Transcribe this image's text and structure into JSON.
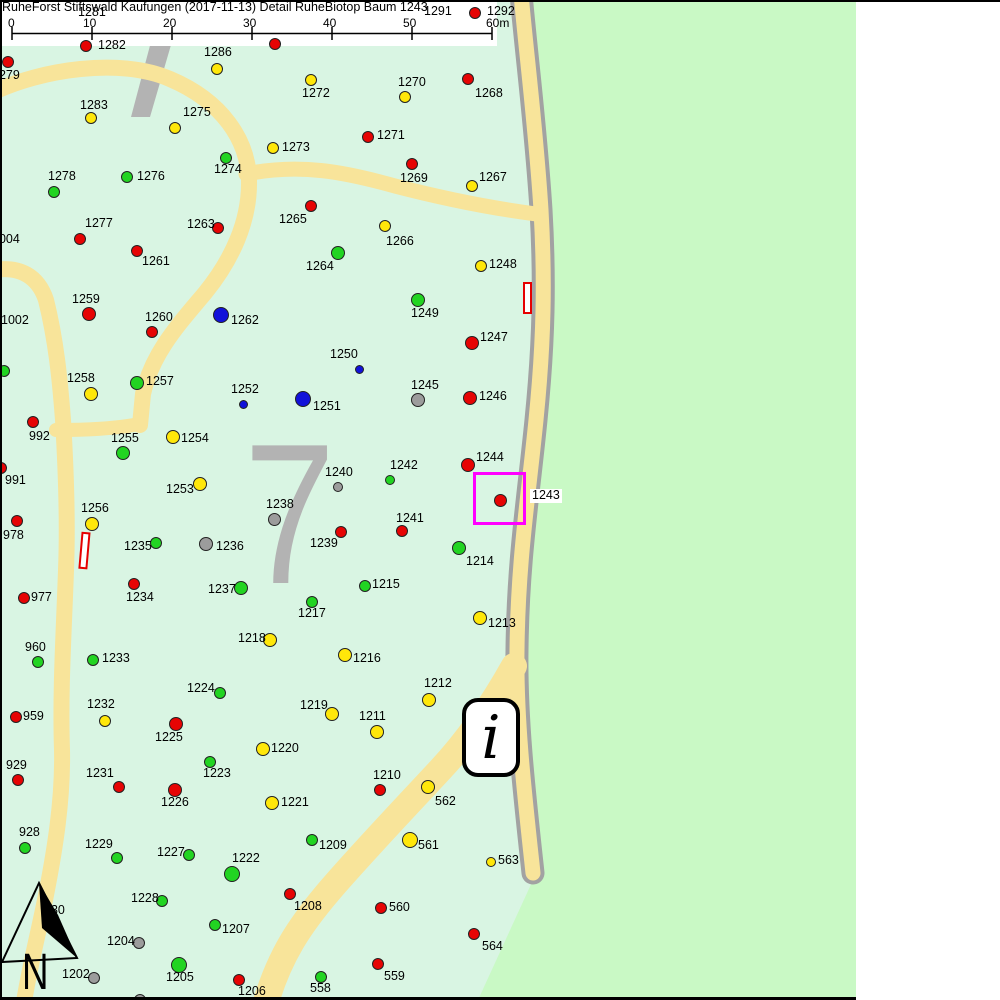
{
  "title": "RuheForst Stiftswald Kaufungen (2017-11-13) Detail  RuheBiotop Baum 1243",
  "scalebar": {
    "labels": [
      "0",
      "10",
      "20",
      "30",
      "40",
      "50",
      "60m"
    ],
    "label_x": [
      8,
      83,
      163,
      243,
      323,
      403,
      486
    ],
    "tick_x": [
      12,
      92,
      172,
      252,
      332,
      412,
      492
    ]
  },
  "north": {
    "label": "N"
  },
  "info_icon": {
    "glyph": "i"
  },
  "compartment": {
    "number": "7"
  },
  "highlight": {
    "tree_id": "1243"
  },
  "colors": {
    "pale_green": "#d9f5e3",
    "bright_green": "#c9f9c5",
    "road_yellow": "#f8e49a",
    "road_gray": "#a2a2a2",
    "shape_gray": "#b3b3b3",
    "magenta": "#ff00ff",
    "dot_red": "#e60404",
    "dot_green": "#22d422",
    "dot_yellow": "#ffe70a",
    "dot_blue": "#1212d9",
    "dot_gray": "#9c9c9c"
  },
  "markers": [
    {
      "l": "1281",
      "c": null,
      "lx": 78,
      "ly": 6
    },
    {
      "l": "1291",
      "c": null,
      "lx": 424,
      "ly": 5
    },
    {
      "l": "1292",
      "c": "red",
      "x": 475,
      "y": 13,
      "r": 6,
      "lx": 487,
      "ly": 5
    },
    {
      "l": "",
      "c": "yellow",
      "x": 138,
      "y": 12,
      "r": 6,
      "z": 20
    },
    {
      "l": "1287",
      "c": "red",
      "x": 275,
      "y": 44,
      "r": 6,
      "lx": 287,
      "ly": 36,
      "lz": 20
    },
    {
      "l": "1282",
      "c": "red",
      "x": 86,
      "y": 46,
      "r": 6,
      "lx": 98,
      "ly": 39
    },
    {
      "l": "1286",
      "c": "yellow",
      "x": 217,
      "y": 69,
      "r": 6,
      "lx": 204,
      "ly": 46
    },
    {
      "l": "1279",
      "c": "red",
      "x": 8,
      "y": 62,
      "r": 6,
      "lx": -8,
      "ly": 69
    },
    {
      "l": "1283",
      "c": "yellow",
      "x": 91,
      "y": 118,
      "r": 6,
      "lx": 80,
      "ly": 99
    },
    {
      "l": "1272",
      "c": "yellow",
      "x": 311,
      "y": 80,
      "r": 6,
      "lx": 302,
      "ly": 87
    },
    {
      "l": "1270",
      "c": "yellow",
      "x": 405,
      "y": 97,
      "r": 6,
      "lx": 398,
      "ly": 76
    },
    {
      "l": "1268",
      "c": "red",
      "x": 468,
      "y": 79,
      "r": 6,
      "lx": 475,
      "ly": 87
    },
    {
      "l": "1275",
      "c": "yellow",
      "x": 175,
      "y": 128,
      "r": 6,
      "lx": 183,
      "ly": 106
    },
    {
      "l": "1273",
      "c": "yellow",
      "x": 273,
      "y": 148,
      "r": 6,
      "lx": 282,
      "ly": 141
    },
    {
      "l": "1271",
      "c": "red",
      "x": 368,
      "y": 137,
      "r": 6,
      "lx": 377,
      "ly": 129
    },
    {
      "l": "1274",
      "c": "green",
      "x": 226,
      "y": 158,
      "r": 6,
      "lx": 214,
      "ly": 163
    },
    {
      "l": "1276",
      "c": "green",
      "x": 127,
      "y": 177,
      "r": 6,
      "lx": 137,
      "ly": 170
    },
    {
      "l": "1278",
      "c": "green",
      "x": 54,
      "y": 192,
      "r": 6,
      "lx": 48,
      "ly": 170
    },
    {
      "l": "1269",
      "c": "red",
      "x": 412,
      "y": 164,
      "r": 6,
      "lx": 400,
      "ly": 172
    },
    {
      "l": "1267",
      "c": "yellow",
      "x": 472,
      "y": 186,
      "r": 6,
      "lx": 479,
      "ly": 171
    },
    {
      "l": "1265",
      "c": "red",
      "x": 311,
      "y": 206,
      "r": 6,
      "lx": 279,
      "ly": 213
    },
    {
      "l": "1277",
      "c": "red",
      "x": 80,
      "y": 239,
      "r": 6,
      "lx": 85,
      "ly": 217
    },
    {
      "l": "1263",
      "c": "red",
      "x": 218,
      "y": 228,
      "r": 6,
      "lx": 187,
      "ly": 218
    },
    {
      "l": "1266",
      "c": "yellow",
      "x": 385,
      "y": 226,
      "r": 6,
      "lx": 386,
      "ly": 235
    },
    {
      "l": "1261",
      "c": "red",
      "x": 137,
      "y": 251,
      "r": 6,
      "lx": 142,
      "ly": 255
    },
    {
      "l": "1264",
      "c": "green",
      "x": 338,
      "y": 253,
      "r": 7,
      "lx": 306,
      "ly": 260
    },
    {
      "l": "1248",
      "c": "yellow",
      "x": 481,
      "y": 266,
      "r": 6,
      "lx": 489,
      "ly": 258
    },
    {
      "l": "1004",
      "c": null,
      "lx": -8,
      "ly": 233
    },
    {
      "l": "1259",
      "c": "red",
      "x": 89,
      "y": 314,
      "r": 7,
      "lx": 72,
      "ly": 293
    },
    {
      "l": "1002",
      "c": null,
      "lx": 1,
      "ly": 314
    },
    {
      "l": "1260",
      "c": "red",
      "x": 152,
      "y": 332,
      "r": 6,
      "lx": 145,
      "ly": 311
    },
    {
      "l": "1262",
      "c": "blue",
      "x": 221,
      "y": 315,
      "r": 8,
      "lx": 231,
      "ly": 314
    },
    {
      "l": "1258",
      "c": "yellow",
      "x": 91,
      "y": 394,
      "r": 7,
      "lx": 67,
      "ly": 372
    },
    {
      "l": "1257",
      "c": "green",
      "x": 137,
      "y": 383,
      "r": 7,
      "lx": 146,
      "ly": 375
    },
    {
      "l": "1252",
      "c": "blue",
      "x": 243,
      "y": 404,
      "r": 4.5,
      "lx": 231,
      "ly": 383
    },
    {
      "l": "992",
      "c": "red",
      "x": 33,
      "y": 422,
      "r": 6,
      "lx": 29,
      "ly": 430
    },
    {
      "l": "1255",
      "c": "green",
      "x": 123,
      "y": 453,
      "r": 7,
      "lx": 111,
      "ly": 432
    },
    {
      "l": "1254",
      "c": "yellow",
      "x": 173,
      "y": 437,
      "r": 7,
      "lx": 181,
      "ly": 432
    },
    {
      "l": "991",
      "c": "red",
      "x": 1,
      "y": 468,
      "r": 6,
      "lx": 5,
      "ly": 474
    },
    {
      "l": "1253",
      "c": "yellow",
      "x": 200,
      "y": 484,
      "r": 7,
      "lx": 166,
      "ly": 483
    },
    {
      "l": "1256",
      "c": "yellow",
      "x": 92,
      "y": 524,
      "r": 7,
      "lx": 81,
      "ly": 502
    },
    {
      "l": "978",
      "c": "red",
      "x": 17,
      "y": 521,
      "r": 6,
      "lx": 3,
      "ly": 529
    },
    {
      "l": "",
      "c": "green",
      "x": 4,
      "y": 371,
      "r": 6
    },
    {
      "l": "1249",
      "c": "green",
      "x": 418,
      "y": 300,
      "r": 7,
      "lx": 411,
      "ly": 307
    },
    {
      "l": "1247",
      "c": "red",
      "x": 472,
      "y": 343,
      "r": 7,
      "lx": 480,
      "ly": 331
    },
    {
      "l": "1250",
      "c": "blue",
      "x": 359,
      "y": 369,
      "r": 4.5,
      "lx": 330,
      "ly": 348
    },
    {
      "l": "1251",
      "c": "blue",
      "x": 303,
      "y": 399,
      "r": 8,
      "lx": 313,
      "ly": 400
    },
    {
      "l": "1245",
      "c": "gray",
      "x": 418,
      "y": 400,
      "r": 7,
      "lx": 411,
      "ly": 379
    },
    {
      "l": "1246",
      "c": "red",
      "x": 470,
      "y": 398,
      "r": 7,
      "lx": 479,
      "ly": 390
    },
    {
      "l": "1244",
      "c": "red",
      "x": 468,
      "y": 465,
      "r": 7,
      "lx": 476,
      "ly": 451
    },
    {
      "l": "1242",
      "c": "green",
      "x": 390,
      "y": 480,
      "r": 5,
      "lx": 390,
      "ly": 459
    },
    {
      "l": "1240",
      "c": "gray",
      "x": 338,
      "y": 487,
      "r": 5,
      "lx": 325,
      "ly": 466
    },
    {
      "l": "1243",
      "c": "red",
      "x": 500,
      "y": 500,
      "r": 6.5,
      "lx": 530,
      "ly": 489,
      "bg": true
    },
    {
      "l": "1238",
      "c": "gray",
      "x": 274,
      "y": 519,
      "r": 6.5,
      "lx": 266,
      "ly": 498
    },
    {
      "l": "1241",
      "c": "red",
      "x": 402,
      "y": 531,
      "r": 6,
      "lx": 396,
      "ly": 512
    },
    {
      "l": "1239",
      "c": "red",
      "x": 341,
      "y": 532,
      "r": 6,
      "lx": 310,
      "ly": 537
    },
    {
      "l": "1235",
      "c": "green",
      "x": 156,
      "y": 543,
      "r": 6,
      "lx": 124,
      "ly": 540
    },
    {
      "l": "1236",
      "c": "gray",
      "x": 206,
      "y": 544,
      "r": 7,
      "lx": 216,
      "ly": 540
    },
    {
      "l": "1234",
      "c": "red",
      "x": 134,
      "y": 584,
      "r": 6,
      "lx": 126,
      "ly": 591
    },
    {
      "l": "1237",
      "c": "green",
      "x": 241,
      "y": 588,
      "r": 7,
      "lx": 208,
      "ly": 583
    },
    {
      "l": "977",
      "c": "red",
      "x": 24,
      "y": 598,
      "r": 6,
      "lx": 31,
      "ly": 591
    },
    {
      "l": "1218",
      "c": "yellow",
      "x": 270,
      "y": 640,
      "r": 7,
      "lx": 238,
      "ly": 632
    },
    {
      "l": "960",
      "c": "green",
      "x": 38,
      "y": 662,
      "r": 6,
      "lx": 25,
      "ly": 641
    },
    {
      "l": "1233",
      "c": "green",
      "x": 93,
      "y": 660,
      "r": 6,
      "lx": 102,
      "ly": 652
    },
    {
      "l": "1224",
      "c": "green",
      "x": 220,
      "y": 693,
      "r": 6,
      "lx": 187,
      "ly": 682
    },
    {
      "l": "1232",
      "c": "yellow",
      "x": 105,
      "y": 721,
      "r": 6,
      "lx": 87,
      "ly": 698
    },
    {
      "l": "959",
      "c": "red",
      "x": 16,
      "y": 717,
      "r": 6,
      "lx": 23,
      "ly": 710
    },
    {
      "l": "1225",
      "c": "red",
      "x": 176,
      "y": 724,
      "r": 7,
      "lx": 155,
      "ly": 731
    },
    {
      "l": "1220",
      "c": "yellow",
      "x": 263,
      "y": 749,
      "r": 7,
      "lx": 271,
      "ly": 742
    },
    {
      "l": "1214",
      "c": "green",
      "x": 459,
      "y": 548,
      "r": 7,
      "lx": 466,
      "ly": 555
    },
    {
      "l": "1215",
      "c": "green",
      "x": 365,
      "y": 586,
      "r": 6,
      "lx": 372,
      "ly": 578
    },
    {
      "l": "1217",
      "c": "green",
      "x": 312,
      "y": 602,
      "r": 6,
      "lx": 298,
      "ly": 607
    },
    {
      "l": "1213",
      "c": "yellow",
      "x": 480,
      "y": 618,
      "r": 7,
      "lx": 488,
      "ly": 617
    },
    {
      "l": "1216",
      "c": "yellow",
      "x": 345,
      "y": 655,
      "r": 7,
      "lx": 353,
      "ly": 652
    },
    {
      "l": "1212",
      "c": "yellow",
      "x": 429,
      "y": 700,
      "r": 7,
      "lx": 424,
      "ly": 677
    },
    {
      "l": "1219",
      "c": "yellow",
      "x": 332,
      "y": 714,
      "r": 7,
      "lx": 300,
      "ly": 699
    },
    {
      "l": "1211",
      "c": "yellow",
      "x": 377,
      "y": 732,
      "r": 7,
      "lx": 359,
      "ly": 710
    },
    {
      "l": "929",
      "c": "red",
      "x": 18,
      "y": 780,
      "r": 6,
      "lx": 6,
      "ly": 759
    },
    {
      "l": "1231",
      "c": "red",
      "x": 119,
      "y": 787,
      "r": 6,
      "lx": 86,
      "ly": 767
    },
    {
      "l": "1226",
      "c": "red",
      "x": 175,
      "y": 790,
      "r": 7,
      "lx": 161,
      "ly": 796
    },
    {
      "l": "1223",
      "c": "green",
      "x": 210,
      "y": 762,
      "r": 6,
      "lx": 203,
      "ly": 767
    },
    {
      "l": "1221",
      "c": "yellow",
      "x": 272,
      "y": 803,
      "r": 7,
      "lx": 281,
      "ly": 796
    },
    {
      "l": "928",
      "c": "green",
      "x": 25,
      "y": 848,
      "r": 6,
      "lx": 19,
      "ly": 826
    },
    {
      "l": "1229",
      "c": "green",
      "x": 117,
      "y": 858,
      "r": 6,
      "lx": 85,
      "ly": 838
    },
    {
      "l": "1227",
      "c": "green",
      "x": 189,
      "y": 855,
      "r": 6,
      "lx": 157,
      "ly": 846
    },
    {
      "l": "1222",
      "c": "green",
      "x": 232,
      "y": 874,
      "r": 8,
      "lx": 232,
      "ly": 852
    },
    {
      "l": "1228",
      "c": "green",
      "x": 162,
      "y": 901,
      "r": 6,
      "lx": 131,
      "ly": 892
    },
    {
      "l": "1207",
      "c": "green",
      "x": 215,
      "y": 925,
      "r": 6,
      "lx": 222,
      "ly": 923
    },
    {
      "l": "1204",
      "c": "gray",
      "x": 139,
      "y": 943,
      "r": 6,
      "lx": 107,
      "ly": 935
    },
    {
      "l": "1205",
      "c": "green",
      "x": 179,
      "y": 965,
      "r": 8,
      "lx": 166,
      "ly": 971
    },
    {
      "l": "1202",
      "c": "gray",
      "x": 94,
      "y": 978,
      "r": 6,
      "lx": 62,
      "ly": 968
    },
    {
      "l": "1206",
      "c": "red",
      "x": 239,
      "y": 980,
      "r": 6,
      "lx": 238,
      "ly": 985
    },
    {
      "l": "930",
      "c": null,
      "lx": 44,
      "ly": 904,
      "lz": 20
    },
    {
      "l": "",
      "c": "gray",
      "x": 140,
      "y": 1000,
      "r": 6
    },
    {
      "l": "1210",
      "c": "red",
      "x": 380,
      "y": 790,
      "r": 6,
      "lx": 373,
      "ly": 769
    },
    {
      "l": "562",
      "c": "yellow",
      "x": 428,
      "y": 787,
      "r": 7,
      "lx": 435,
      "ly": 795
    },
    {
      "l": "1209",
      "c": "green",
      "x": 312,
      "y": 840,
      "r": 6,
      "lx": 319,
      "ly": 839
    },
    {
      "l": "561",
      "c": "yellow",
      "x": 410,
      "y": 840,
      "r": 8,
      "lx": 418,
      "ly": 839
    },
    {
      "l": "563",
      "c": "yellow",
      "x": 491,
      "y": 862,
      "r": 5,
      "lx": 498,
      "ly": 854
    },
    {
      "l": "1208",
      "c": "red",
      "x": 290,
      "y": 894,
      "r": 6,
      "lx": 294,
      "ly": 900
    },
    {
      "l": "560",
      "c": "red",
      "x": 381,
      "y": 908,
      "r": 6,
      "lx": 389,
      "ly": 901
    },
    {
      "l": "564",
      "c": "red",
      "x": 474,
      "y": 934,
      "r": 6,
      "lx": 482,
      "ly": 940
    },
    {
      "l": "559",
      "c": "red",
      "x": 378,
      "y": 964,
      "r": 6,
      "lx": 384,
      "ly": 970
    },
    {
      "l": "558",
      "c": "green",
      "x": 321,
      "y": 977,
      "r": 6,
      "lx": 310,
      "ly": 982
    }
  ]
}
